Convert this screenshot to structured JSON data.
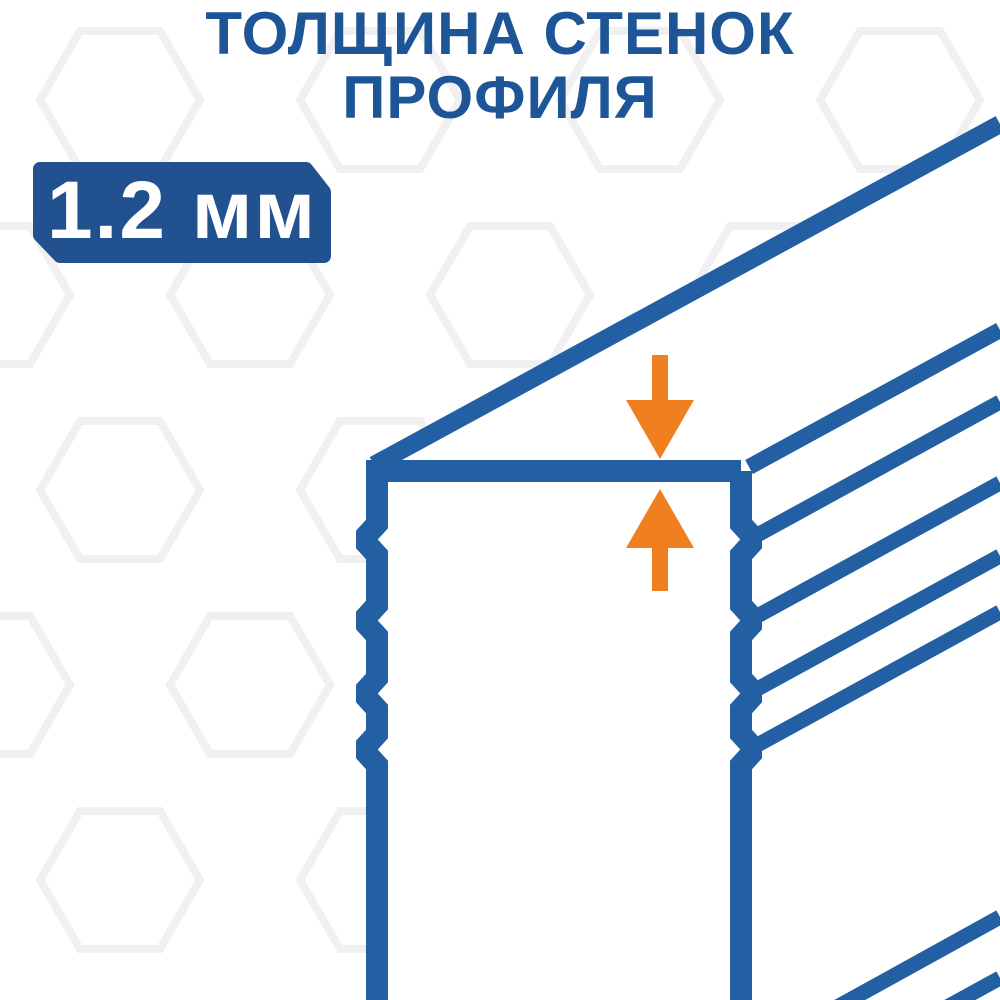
{
  "page": {
    "width": 1000,
    "height": 1000,
    "background": "#ffffff"
  },
  "title": {
    "line1": "ТОЛЩИНА СТЕНОК",
    "line2": "ПРОФИЛЯ",
    "color": "#1d5596"
  },
  "badge": {
    "label": "1.2 мм",
    "background": "#21518e",
    "text_color": "#ffffff"
  },
  "diagram": {
    "depicts": "corner of hollow profile tube, wall thickness marked by two arrows",
    "line_color": "#2260a3",
    "arrow_color": "#f0801f",
    "hexagon_pattern_color": "#f0f0f2",
    "icons": [
      "arrow-down-icon",
      "arrow-up-icon"
    ]
  }
}
